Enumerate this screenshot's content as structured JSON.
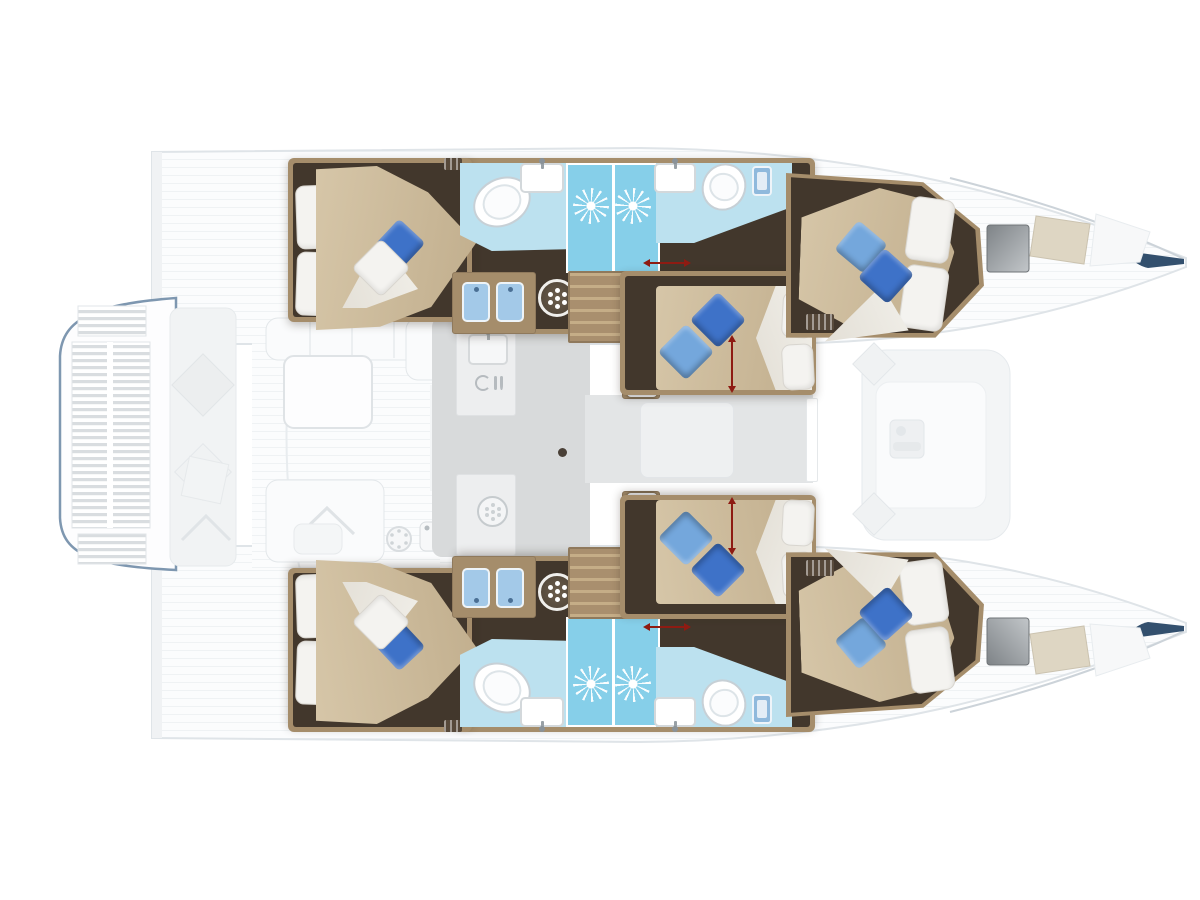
{
  "diagram": {
    "kind": "catamaran-yacht-floor-plan",
    "view": "top-down interior layout",
    "orientation": {
      "bow": "right",
      "stern": "left"
    },
    "hulls": [
      {
        "name": "port-hull",
        "rooms": [
          {
            "name": "aft-cabin",
            "features": [
              "double-bed",
              "white-head-pillows",
              "blue-pillow",
              "white-throw-pillow"
            ]
          },
          {
            "name": "aft-head",
            "features": [
              "toilet",
              "sink-with-faucet"
            ]
          },
          {
            "name": "shower",
            "features": [
              "shower-jet-starburst",
              "shower-jet-starburst"
            ]
          },
          {
            "name": "forward-head",
            "features": [
              "sink-with-faucet",
              "toilet",
              "hand-shower-fixture"
            ]
          },
          {
            "name": "vanity",
            "features": [
              "twin-blue-basins",
              "round-shower-drain"
            ]
          },
          {
            "name": "companionway-stairs",
            "features": [
              "wood-steps"
            ]
          },
          {
            "name": "mid-cabin",
            "features": [
              "double-bed",
              "blue-pillow",
              "light-blue-pillow",
              "white-pillows",
              "bed-extension-arrow",
              "towel-shelves"
            ]
          },
          {
            "name": "forward-cabin",
            "features": [
              "double-bed",
              "blue-pillow",
              "light-blue-pillow",
              "white-pillows",
              "air-vent"
            ]
          }
        ]
      },
      {
        "name": "starboard-hull",
        "rooms": "mirror of port hull"
      }
    ],
    "bridge_deck": {
      "salon": {
        "features": [
          "galley-counter",
          "galley-sink",
          "cooktop",
          "burner",
          "mast-post",
          "forward-corridor",
          "forward-door"
        ]
      },
      "aft_cockpit": {
        "features": [
          "l-shaped-sofa",
          "table",
          "helm-bench",
          "grill-burner",
          "outdoor-sink",
          "aft-bench-with-cushions"
        ]
      },
      "stern_platform": {
        "features": [
          "teak-grating-upper",
          "teak-grating-main",
          "teak-grating-lower",
          "blue-transom-outline"
        ]
      },
      "foredeck_lounge": {
        "features": [
          "sun-lounger",
          "diamond-cushion",
          "diamond-cushion",
          "deck-locker"
        ]
      },
      "bow_deck": {
        "features": [
          "tinted-deck-hatch",
          "beige-skylight",
          "bow-accent"
        ]
      }
    },
    "annotations": [
      {
        "name": "sliding-door-arrow",
        "color": "red",
        "count": 2
      },
      {
        "name": "bed-extension-arrow",
        "color": "red",
        "count": 2
      }
    ],
    "counts": {
      "cabins": 6,
      "heads": 4,
      "showers": 4
    }
  },
  "colors": {
    "floorDark": "#42372c",
    "wood": "#a58d6b",
    "woodLight": "#c3ac8a",
    "bedBeige": "#c9b697",
    "pillowWhite": "#f4f3f0",
    "pillowBlue": "#3e72c8",
    "pillowLightBlue": "#74a7dc",
    "bathFloor": "#bce1ef",
    "showerFloor": "#86cfe9",
    "vanityBlue": "#a3c9e8",
    "salonFloor": "#d8dadb",
    "corridorFloor": "#e3e5e6",
    "counter": "#edeeef",
    "exteriorLine": "#dfe4e8",
    "platformSlat": "#d9dde0",
    "transomBlue": "#7e97b0",
    "red": "#8e1b12",
    "hatchDark": "#7e8387",
    "hatchLight": "#c2c6c9",
    "skylight": "#ded6c3",
    "bowAccent": "#33506e"
  }
}
